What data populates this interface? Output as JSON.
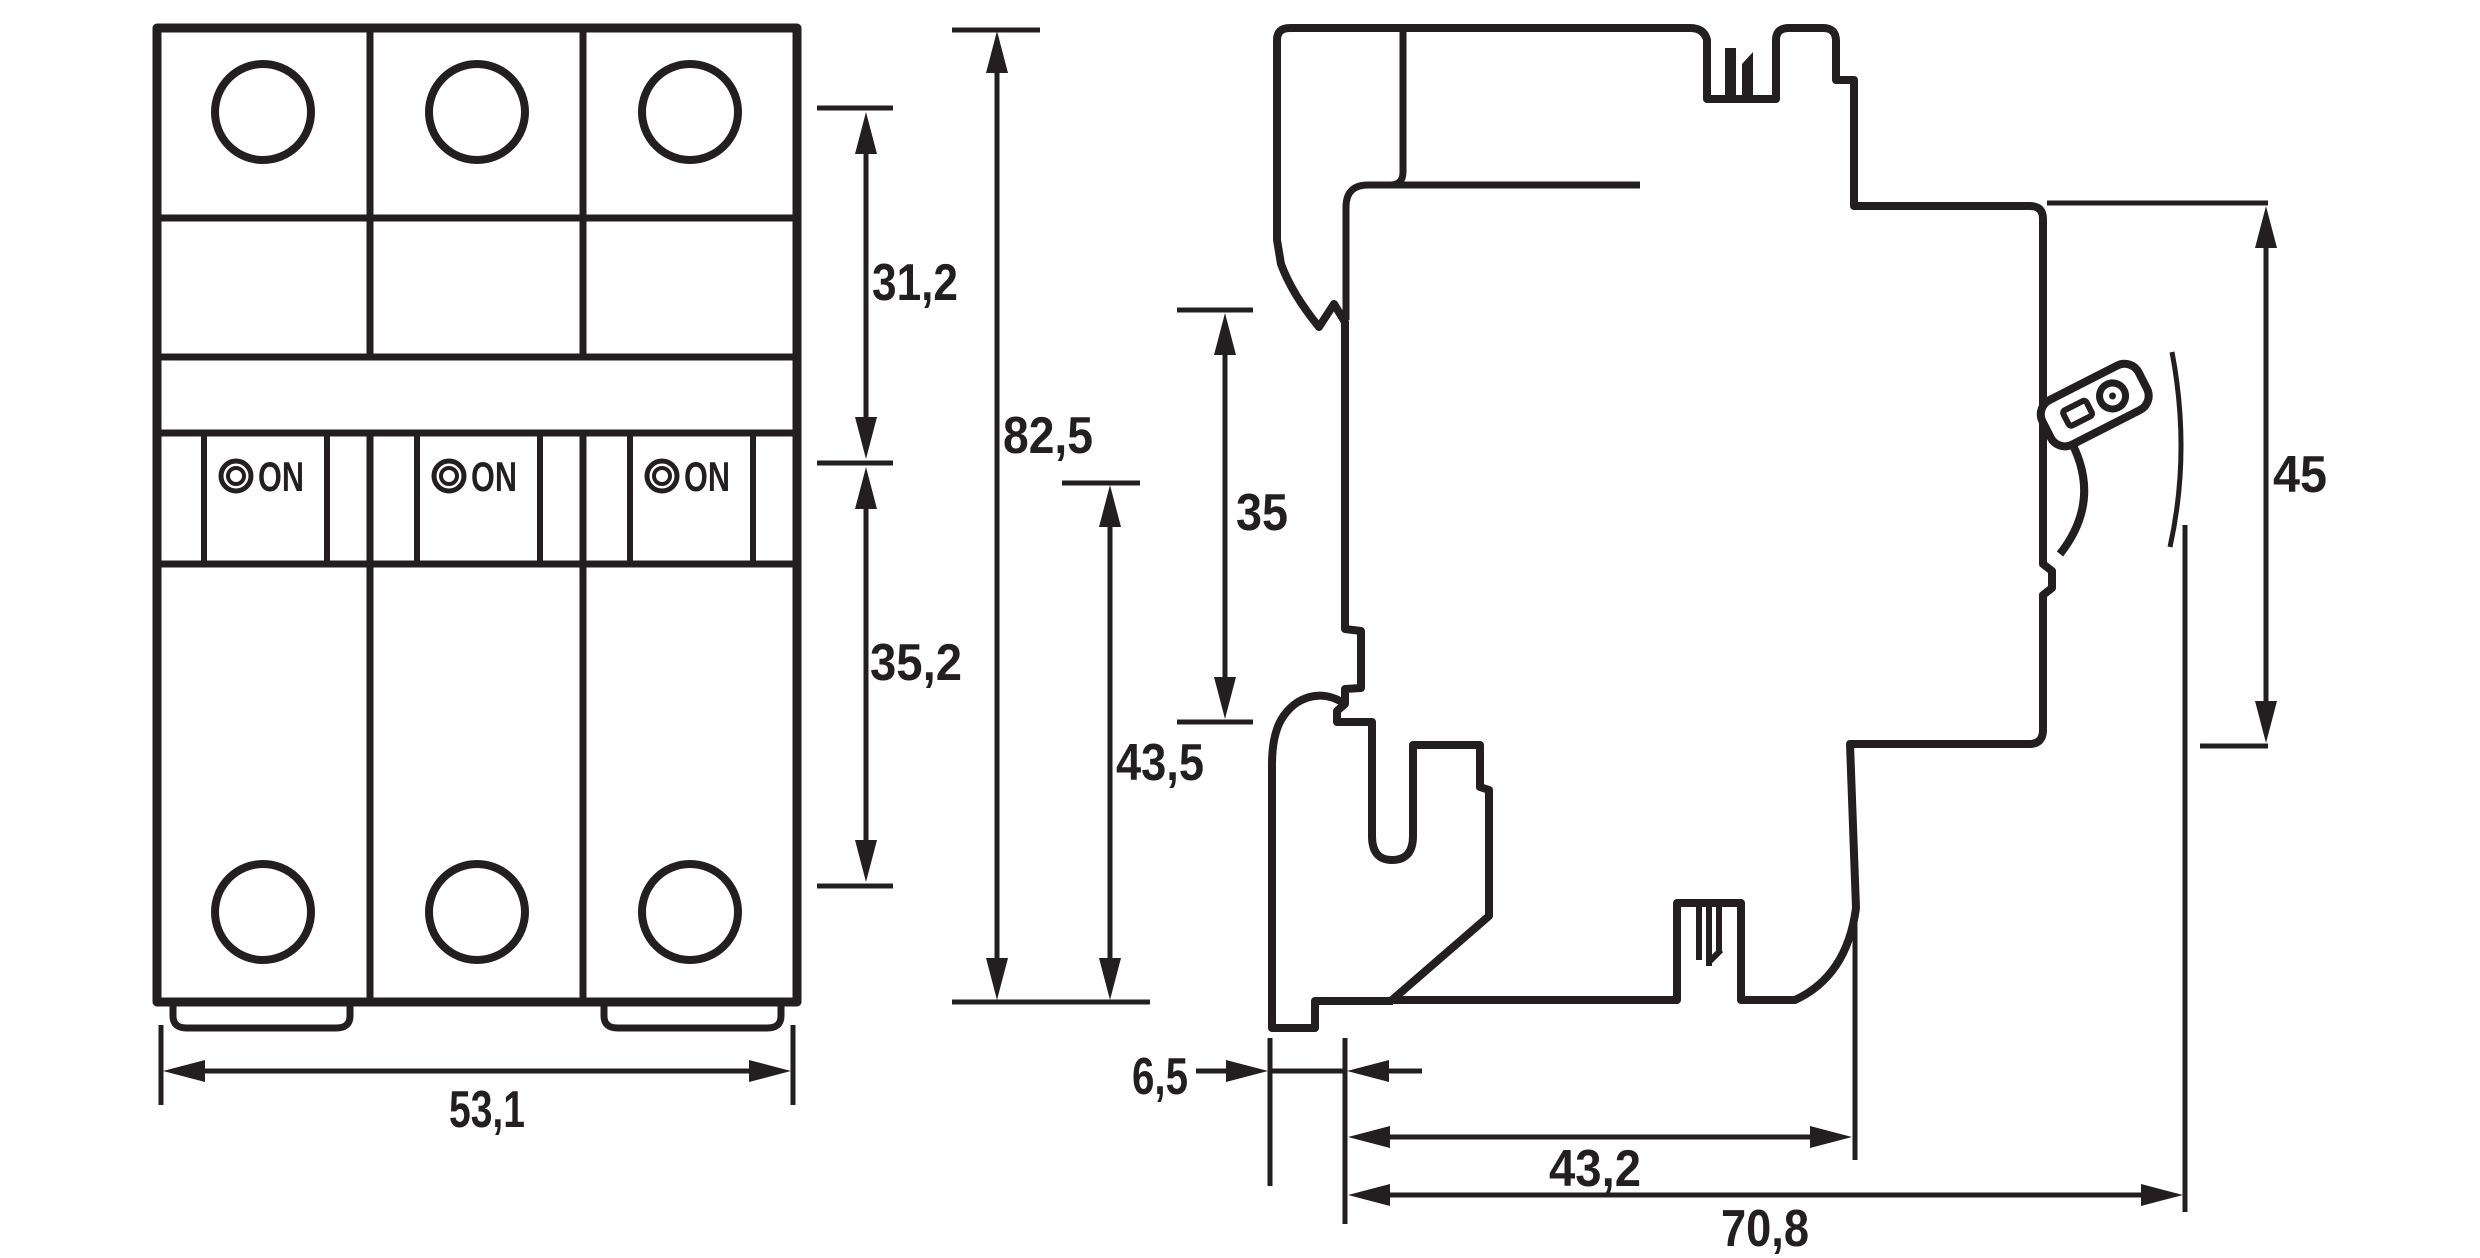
{
  "drawing": {
    "kind": "dimensional-drawing",
    "subject": "3-pole miniature circuit breaker, front view and side view",
    "units_shown": false
  },
  "front_view": {
    "poles": [
      {
        "indicator_label": "ON"
      },
      {
        "indicator_label": "ON"
      },
      {
        "indicator_label": "ON"
      }
    ]
  },
  "dimensions": {
    "front_width": {
      "label": "53,1"
    },
    "upper_section_height": {
      "label": "31,2"
    },
    "lower_section_height": {
      "label": "35,2"
    },
    "total_height": {
      "label": "82,5"
    },
    "din_rail_seat_height": {
      "label": "35"
    },
    "rail_to_bottom_height": {
      "label": "43,5"
    },
    "front_face_height": {
      "label": "45"
    },
    "rail_recess_depth": {
      "label": "6,5"
    },
    "mounting_depth": {
      "label": "43,2"
    },
    "total_depth": {
      "label": "70,8"
    }
  },
  "colors": {
    "ink": "#231f20",
    "background": "#ffffff"
  }
}
